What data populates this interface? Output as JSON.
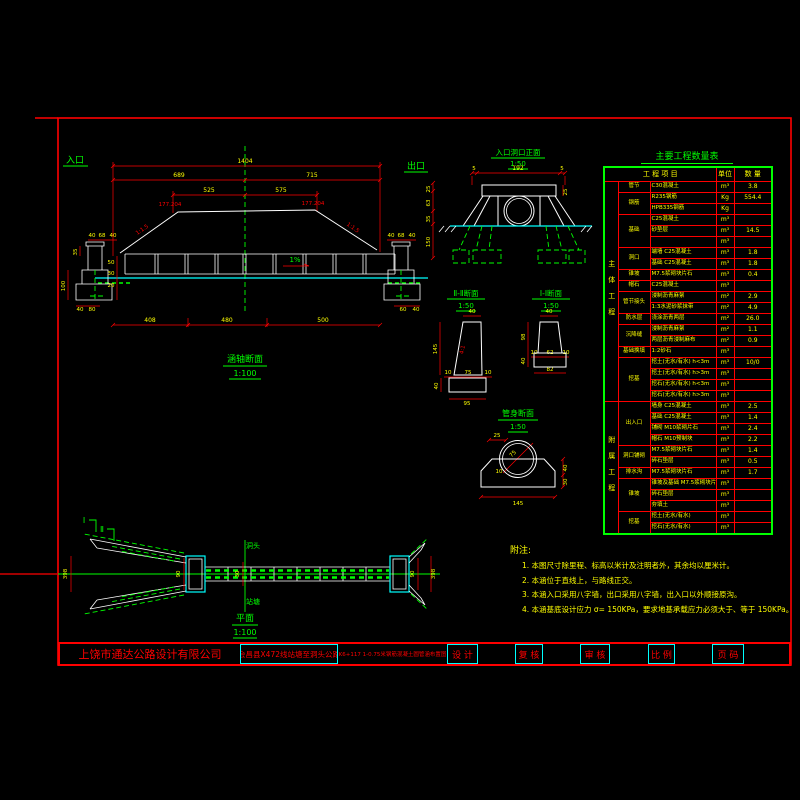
{
  "ls": {
    "title": "涵轴断面",
    "scale": "1:100",
    "inlet": "入口",
    "outlet": "出口",
    "dims": {
      "total": "1404",
      "left": "689",
      "right": "715",
      "l2": "525",
      "r2": "575",
      "elev_left": "177.204",
      "elev_right": "177.204",
      "slope_left": "1:1.5",
      "slope_right": "1:1.5",
      "grade": "1%",
      "lp": [
        "40",
        "68",
        "40",
        "35",
        "100",
        "50",
        "30",
        "20",
        "40",
        "80"
      ],
      "rp": [
        "40",
        "68",
        "40",
        "60",
        "40"
      ],
      "rchain": [
        "25",
        "63",
        "35",
        "150"
      ],
      "bottom": [
        "408",
        "480",
        "500"
      ]
    }
  },
  "pf": {
    "title": "入口洞口正面",
    "scale": "1:50",
    "dims": {
      "a": "5",
      "b": "192",
      "c": "5",
      "d": "25"
    }
  },
  "s2": {
    "title": "Ⅱ-Ⅱ断面",
    "scale": "1:50",
    "dims": {
      "top": "40",
      "h": "145",
      "a": "10",
      "b": "75",
      "c": "10",
      "fh": "40",
      "fw": "95",
      "slope": "4:1"
    }
  },
  "s1": {
    "title": "Ⅰ-Ⅰ断面",
    "scale": "1:50",
    "dims": {
      "top": "40",
      "h": "98",
      "a": "10",
      "b": "62",
      "c": "10",
      "fh": "40",
      "fw": "82"
    }
  },
  "ps": {
    "title": "管身断面",
    "scale": "1:50",
    "dims": {
      "a": "25",
      "dia": "75",
      "b": "10",
      "c": "40",
      "d": "30",
      "w": "145"
    }
  },
  "pl": {
    "title": "平面",
    "scale": "1:100",
    "dir_top": "洞头",
    "dir_bottom": "站塘",
    "sec1": "Ⅰ",
    "sec2": "Ⅱ",
    "dims": {
      "lw": "398",
      "lh": "90",
      "rh": "90",
      "rw": "398",
      "joint": "30"
    }
  },
  "table": {
    "title": "主要工程数量表",
    "header": {
      "item": "工 程 项 目",
      "unit": "单位",
      "qty": "数 量"
    },
    "rows": [
      [
        "主体工程",
        "管节",
        "C30混凝土",
        "m³",
        "3.8"
      ],
      [
        "主体工程",
        "钢筋",
        "R235钢筋",
        "Kg",
        "554.4"
      ],
      [
        "主体工程",
        "钢筋",
        "HPB335钢筋",
        "Kg",
        ""
      ],
      [
        "主体工程",
        "基础",
        "C25混凝土",
        "m³",
        ""
      ],
      [
        "主体工程",
        "基础",
        "砂垫层",
        "m³",
        "14.5"
      ],
      [
        "主体工程",
        "基础",
        "",
        "m³",
        ""
      ],
      [
        "主体工程",
        "洞口",
        "端墙 C25混凝土",
        "m³",
        "1.8"
      ],
      [
        "主体工程",
        "洞口",
        "基础 C25混凝土",
        "m³",
        "1.8"
      ],
      [
        "主体工程",
        "锥坡",
        "M7.5浆砌块片石",
        "m³",
        "0.4"
      ],
      [
        "主体工程",
        "帽石",
        "C25混凝土",
        "m³",
        ""
      ],
      [
        "主体工程",
        "管节接头",
        "浸制沥青麻絮",
        "m²",
        "2.9"
      ],
      [
        "主体工程",
        "管节接头",
        "1:3水泥砂浆抹带",
        "m²",
        "4.9"
      ],
      [
        "主体工程",
        "防水层",
        "浇涂沥青两层",
        "m²",
        "26.0"
      ],
      [
        "主体工程",
        "沉降缝",
        "浸制沥青麻絮",
        "m²",
        "1.1"
      ],
      [
        "主体工程",
        "沉降缝",
        "两层沥青浸制麻布",
        "m²",
        "0.9"
      ],
      [
        "主体工程",
        "基础换填",
        "1:2砂石",
        "m³",
        ""
      ],
      [
        "主体工程",
        "挖基",
        "挖土(无水/有水) h<3m",
        "m³",
        "10/0"
      ],
      [
        "主体工程",
        "挖基",
        "挖土(无水/有水) h>3m",
        "m³",
        ""
      ],
      [
        "主体工程",
        "挖基",
        "挖石(无水/有水) h<3m",
        "m³",
        ""
      ],
      [
        "主体工程",
        "挖基",
        "挖石(无水/有水) h>3m",
        "m³",
        ""
      ],
      [
        "附属工程",
        "出入口",
        "墙身 C25混凝土",
        "m³",
        "2.5"
      ],
      [
        "附属工程",
        "出入口",
        "基础 C25混凝土",
        "m³",
        "1.4"
      ],
      [
        "附属工程",
        "出入口",
        "铺砌 M10浆砌片石",
        "m³",
        "2.4"
      ],
      [
        "附属工程",
        "出入口",
        "帽石 M10预制块",
        "m³",
        "2.2"
      ],
      [
        "附属工程",
        "洞口铺砌",
        "M7.5浆砌块片石",
        "m³",
        "1.4"
      ],
      [
        "附属工程",
        "洞口铺砌",
        "碎石垫层",
        "m³",
        "0.5"
      ],
      [
        "附属工程",
        "排水沟",
        "M7.5浆砌块片石",
        "m³",
        "1.7"
      ],
      [
        "附属工程",
        "锥坡",
        "锥坡及基础 M7.5浆砌块片石",
        "m³",
        ""
      ],
      [
        "附属工程",
        "锥坡",
        "碎石垫层",
        "m³",
        ""
      ],
      [
        "附属工程",
        "锥坡",
        "夯填土",
        "m³",
        ""
      ],
      [
        "附属工程",
        "挖基",
        "挖土(无水/有水)",
        "m³",
        ""
      ],
      [
        "附属工程",
        "挖基",
        "挖石(无水/有水)",
        "m³",
        ""
      ]
    ]
  },
  "notes": {
    "title": "附注:",
    "lines": [
      "1. 本图尺寸除里程、标高以米计及注明者外，其余均以厘米计。",
      "2. 本涵位于直线上，与路线正交。",
      "3. 本涵入口采用八字墙，出口采用八字墙，出入口以外顺接原沟。",
      "4. 本涵基底设计应力 σ= 150KPa，要求地基承载应力必须大于、等于 150KPa。"
    ]
  },
  "titleblock": {
    "company": "上饶市通达公路设计有限公司",
    "project": "会昌县X472线站塘至洞头公路",
    "drawing": "K6+117 1-0.75米钢筋混凝土圆管涵布置图",
    "design": "设 计",
    "review": "复 核",
    "check": "审 核",
    "scale": "比 例",
    "page": "页 码"
  }
}
